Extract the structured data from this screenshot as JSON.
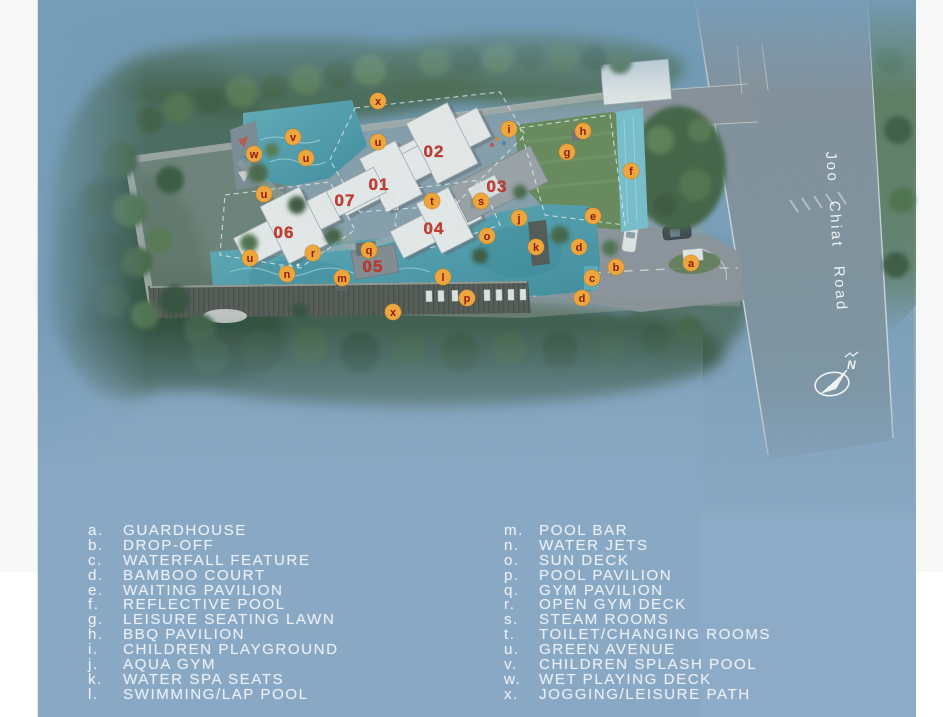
{
  "road": {
    "label": "Joo Chiat Road"
  },
  "compass": {
    "label": "N"
  },
  "legend": {
    "left": [
      {
        "key": "a.",
        "label": "GUARDHOUSE"
      },
      {
        "key": "b.",
        "label": "DROP-OFF"
      },
      {
        "key": "c.",
        "label": "WATERFALL FEATURE"
      },
      {
        "key": "d.",
        "label": "BAMBOO COURT"
      },
      {
        "key": "e.",
        "label": "WAITING PAVILION"
      },
      {
        "key": "f.",
        "label": "REFLECTIVE POOL"
      },
      {
        "key": "g.",
        "label": "LEISURE SEATING LAWN"
      },
      {
        "key": "h.",
        "label": "BBQ PAVILION"
      },
      {
        "key": "i.",
        "label": "CHILDREN PLAYGROUND"
      },
      {
        "key": "j.",
        "label": "AQUA GYM"
      },
      {
        "key": "k.",
        "label": "WATER SPA SEATS"
      },
      {
        "key": "l.",
        "label": "SWIMMING/LAP POOL"
      }
    ],
    "right": [
      {
        "key": "m.",
        "label": "POOL BAR"
      },
      {
        "key": "n.",
        "label": "WATER JETS"
      },
      {
        "key": "o.",
        "label": "SUN DECK"
      },
      {
        "key": "p.",
        "label": "POOL PAVILION"
      },
      {
        "key": "q.",
        "label": "GYM PAVILION"
      },
      {
        "key": "r.",
        "label": "OPEN GYM DECK"
      },
      {
        "key": "s.",
        "label": "STEAM ROOMS"
      },
      {
        "key": "t.",
        "label": "TOILET/CHANGING ROOMS"
      },
      {
        "key": "u.",
        "label": "GREEN AVENUE"
      },
      {
        "key": "v.",
        "label": "CHILDREN SPLASH POOL"
      },
      {
        "key": "w.",
        "label": "WET PLAYING DECK"
      },
      {
        "key": "x.",
        "label": "JOGGING/LEISURE PATH"
      }
    ]
  },
  "plan": {
    "buildings": [
      {
        "id": "01",
        "x": 379,
        "y": 184
      },
      {
        "id": "02",
        "x": 434,
        "y": 151
      },
      {
        "id": "03",
        "x": 497,
        "y": 186
      },
      {
        "id": "04",
        "x": 434,
        "y": 228
      },
      {
        "id": "05",
        "x": 373,
        "y": 266
      },
      {
        "id": "06",
        "x": 284,
        "y": 232
      },
      {
        "id": "07",
        "x": 345,
        "y": 200
      }
    ],
    "markers": [
      {
        "letter": "x",
        "x": 378,
        "y": 101
      },
      {
        "letter": "v",
        "x": 293,
        "y": 137
      },
      {
        "letter": "u",
        "x": 378,
        "y": 142
      },
      {
        "letter": "w",
        "x": 254,
        "y": 154
      },
      {
        "letter": "u",
        "x": 306,
        "y": 158
      },
      {
        "letter": "i",
        "x": 509,
        "y": 129
      },
      {
        "letter": "h",
        "x": 583,
        "y": 131
      },
      {
        "letter": "g",
        "x": 567,
        "y": 152
      },
      {
        "letter": "f",
        "x": 631,
        "y": 171
      },
      {
        "letter": "u",
        "x": 264,
        "y": 194
      },
      {
        "letter": "t",
        "x": 432,
        "y": 201
      },
      {
        "letter": "s",
        "x": 481,
        "y": 201
      },
      {
        "letter": "e",
        "x": 593,
        "y": 216
      },
      {
        "letter": "j",
        "x": 519,
        "y": 218
      },
      {
        "letter": "o",
        "x": 487,
        "y": 236
      },
      {
        "letter": "k",
        "x": 536,
        "y": 247
      },
      {
        "letter": "d",
        "x": 579,
        "y": 247
      },
      {
        "letter": "q",
        "x": 369,
        "y": 250
      },
      {
        "letter": "r",
        "x": 313,
        "y": 253
      },
      {
        "letter": "u",
        "x": 250,
        "y": 258
      },
      {
        "letter": "a",
        "x": 691,
        "y": 263
      },
      {
        "letter": "b",
        "x": 616,
        "y": 267
      },
      {
        "letter": "n",
        "x": 287,
        "y": 274
      },
      {
        "letter": "l",
        "x": 443,
        "y": 277
      },
      {
        "letter": "m",
        "x": 342,
        "y": 278
      },
      {
        "letter": "c",
        "x": 592,
        "y": 278
      },
      {
        "letter": "p",
        "x": 467,
        "y": 298
      },
      {
        "letter": "d",
        "x": 582,
        "y": 298
      },
      {
        "letter": "x",
        "x": 393,
        "y": 312
      }
    ],
    "colors": {
      "page_blue": "#86a6c2",
      "marker": "#eda53d",
      "marker_letter": "#8c1c10",
      "building_number": "#c23527",
      "pool": "#4b9dab",
      "trees": "#3c5a3e",
      "road": "#8a939b"
    }
  }
}
